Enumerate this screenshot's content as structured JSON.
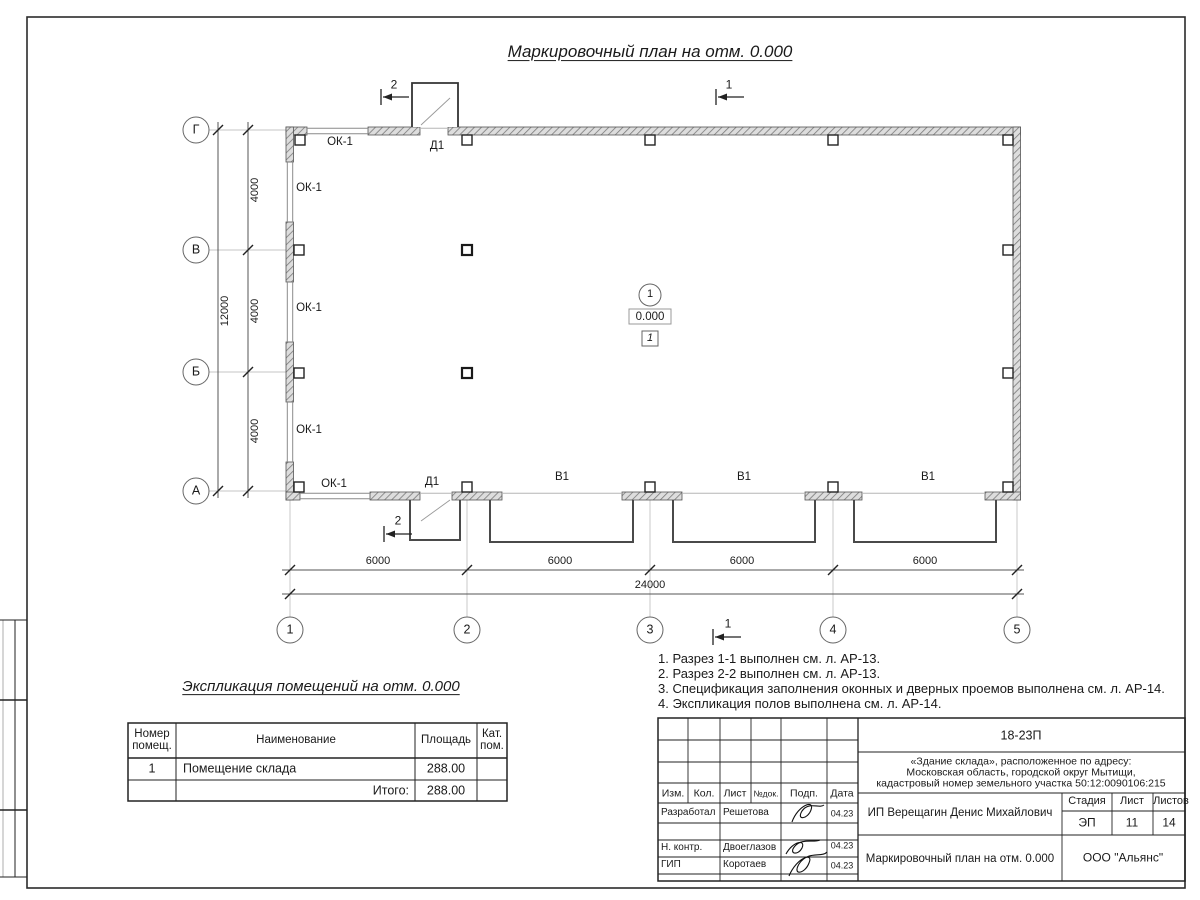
{
  "drawing": {
    "title": "Маркировочный план на отм. 0.000",
    "grid_rows": [
      "Г",
      "В",
      "Б",
      "А"
    ],
    "grid_cols": [
      "1",
      "2",
      "3",
      "4",
      "5"
    ],
    "dims_left": {
      "segments": [
        "4000",
        "4000",
        "4000"
      ],
      "total": "12000"
    },
    "dims_bottom": {
      "segments": [
        "6000",
        "6000",
        "6000",
        "6000"
      ],
      "total": "24000"
    },
    "window_labels": [
      "ОК-1",
      "ОК-1",
      "ОК-1",
      "ОК-1",
      "ОК-1"
    ],
    "door_labels": {
      "top": "Д1",
      "bottom": "Д1"
    },
    "gate_labels": [
      "В1",
      "В1",
      "В1"
    ],
    "section_one": "1",
    "section_two": "2",
    "room_mark": {
      "number": "1",
      "elevation": "0.000",
      "floor_type": "1"
    }
  },
  "notes": {
    "lines": [
      "1. Разрез 1-1 выполнен см. л. АР-13.",
      "2. Разрез 2-2 выполнен см. л. АР-13.",
      "3. Спецификация заполнения оконных и дверных проемов выполнена см. л. АР-14.",
      "4. Экспликация полов выполнена см. л. АР-14."
    ]
  },
  "explication": {
    "title": "Экспликация помещений на отм. 0.000",
    "col_number": "Номер помещ.",
    "col_name": "Наименование",
    "col_area": "Площадь",
    "col_cat": "Кат. пом.",
    "row": {
      "number": "1",
      "name": "Помещение склада",
      "area": "288.00"
    },
    "total_label": "Итого:",
    "total_value": "288.00"
  },
  "titleblock": {
    "doc_number": "18-23П",
    "address_line1": "«Здание склада», расположенное по адресу:",
    "address_line2": "Московская область, городской округ Мытищи,",
    "address_line3": "кадастровый номер земельного участка 50:12:0090106:215",
    "col_izm": "Изм.",
    "col_kol": "Кол.",
    "col_list": "Лист",
    "col_doc": "№док.",
    "col_podp": "Подп.",
    "col_data": "Дата",
    "row1_role": "Разработал",
    "row1_name": "Решетова",
    "row1_date": "04.23",
    "row2_role": "Н. контр.",
    "row2_name": "Двоеглазов",
    "row2_date": "04.23",
    "row3_role": "ГИП",
    "row3_name": "Коротаев",
    "row3_date": "04.23",
    "client": "ИП Верещагин Денис Михайлович",
    "sheet_title": "Маркировочный план на отм. 0.000",
    "stage_label": "Стадия",
    "list_label": "Лист",
    "listov_label": "Листов",
    "stage": "ЭП",
    "list": "11",
    "listov": "14",
    "company": "ООО \"Альянс\""
  },
  "colors": {
    "line": "#1a1a1a",
    "wall_hatch": "#7a7a7a",
    "aux_line": "#c4c4c4"
  }
}
